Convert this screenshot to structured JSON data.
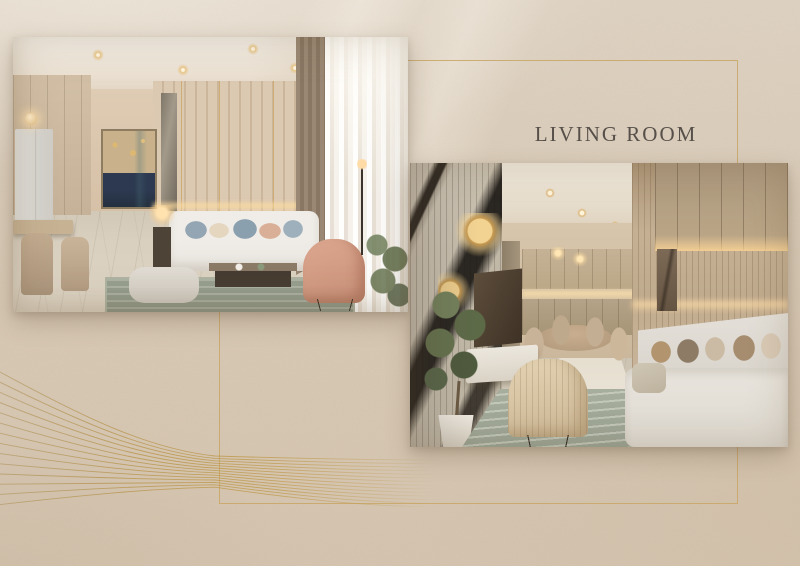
{
  "page": {
    "title": "LIVING ROOM"
  },
  "colors": {
    "background": "#d7c8b4",
    "accent_gold": "#c9a768",
    "title_text": "#57504a"
  },
  "photos": [
    {
      "name": "living-room-view-1",
      "description": "Living room render: white sofa with blue and blush pillows, abstract navy-gold artwork, wood slat wall, kitchen and dining nook at left, blush armchair and sheer curtains at right"
    },
    {
      "name": "living-room-view-2",
      "description": "Living room render: dark veined marble feature wall with round gold sconces, olive tree, TV console, grey sofa along slatted wall, dining area and kitchen in background"
    }
  ],
  "decorations": {
    "frame": "thin gold rectangle border",
    "waves": "gold flowing wave lines"
  }
}
